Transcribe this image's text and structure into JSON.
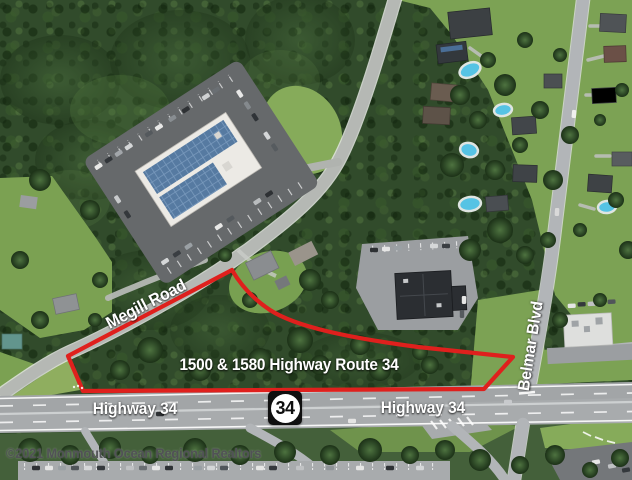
{
  "map": {
    "type": "annotated aerial photo",
    "road_labels": {
      "megill_road": "Megill Road",
      "highway_34_left": "Highway 34",
      "highway_34_right": "Highway 34",
      "belmar_blvd": "Belmar Blvd"
    },
    "property_label": "1500 & 1580 Highway Route 34",
    "route_shield": {
      "number": "34"
    },
    "watermark": "©2021 Monmouth Ocean Regional Realtors",
    "colors": {
      "boundary": "#df201d",
      "label_text": "#ffffff",
      "watermark_text": "#515256",
      "shield_square": "#0f0f0f",
      "shield_circle": "#ffffff",
      "shield_number": "#0f0f0f"
    }
  }
}
